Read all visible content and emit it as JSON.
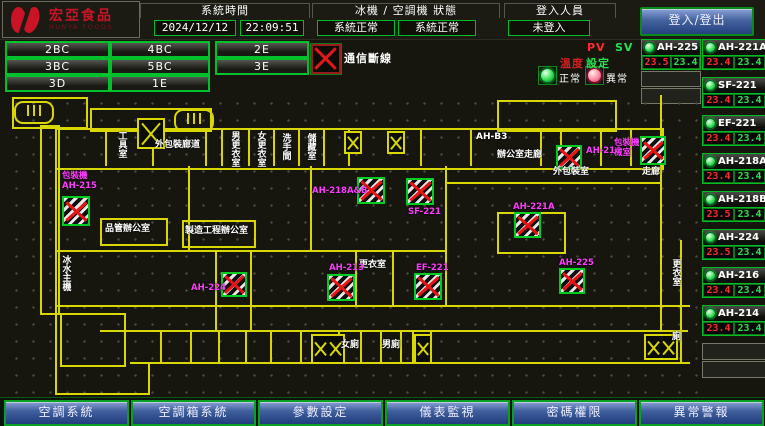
{
  "header": {
    "brand": {
      "name": "宏亞食品",
      "sub": "HUNYA FOODS"
    },
    "system_time": {
      "label": "系統時間",
      "date": "2024/12/12",
      "time": "22:09:51"
    },
    "machine_status": {
      "label": "冰機 / 空調機 狀態",
      "chiller": "系統正常",
      "ac": "系統正常"
    },
    "login": {
      "label": "登入人員",
      "status": "未登入",
      "button": "登入/登出"
    }
  },
  "floor_nav": {
    "buttons": [
      "2BC",
      "4BC",
      "2E",
      "3BC",
      "5BC",
      "3E",
      "3D",
      "1E"
    ]
  },
  "legend": {
    "comm_fail": "通信斷線",
    "normal": "正常",
    "abnormal": "異常"
  },
  "pv_sv": {
    "pv": "PV",
    "sv": "SV",
    "set_prefix": "溫度",
    "set_suffix": "設定"
  },
  "devices": {
    "left": [
      {
        "name": "AH-225",
        "pv": "23.5",
        "sv": "23.4"
      }
    ],
    "left_empty_slots": 2,
    "right": [
      {
        "name": "AH-221A",
        "pv": "23.4",
        "sv": "23.4"
      },
      {
        "name": "SF-221",
        "pv": "23.4",
        "sv": "23.4"
      },
      {
        "name": "EF-221",
        "pv": "23.4",
        "sv": "23.4"
      },
      {
        "name": "AH-218A",
        "pv": "23.4",
        "sv": "23.4"
      },
      {
        "name": "AH-218B",
        "pv": "23.5",
        "sv": "23.4"
      },
      {
        "name": "AH-224",
        "pv": "23.5",
        "sv": "23.4"
      },
      {
        "name": "AH-216",
        "pv": "23.4",
        "sv": "23.4"
      },
      {
        "name": "AH-214",
        "pv": "23.4",
        "sv": "23.4"
      }
    ],
    "right_empty_slots": 2
  },
  "bottom_nav": {
    "buttons": [
      "空調系統",
      "空調箱系統",
      "參數設定",
      "儀表監視",
      "密碼權限",
      "異常警報"
    ]
  },
  "floorplan": {
    "rooms": [
      {
        "label": "工具室",
        "x": 108,
        "y": 36,
        "vertical": true
      },
      {
        "label": "外包裝廊道",
        "x": 147,
        "y": 46,
        "vertical": false
      },
      {
        "label": "男更衣室",
        "x": 221,
        "y": 36,
        "vertical": true
      },
      {
        "label": "女更衣室",
        "x": 247,
        "y": 36,
        "vertical": true
      },
      {
        "label": "洗手間",
        "x": 272,
        "y": 38,
        "vertical": true
      },
      {
        "label": "儲藏室",
        "x": 297,
        "y": 38,
        "vertical": true
      },
      {
        "label": "AH-B3",
        "x": 468,
        "y": 38,
        "vertical": false
      },
      {
        "label": "辦公室走廊",
        "x": 489,
        "y": 56,
        "vertical": false
      },
      {
        "label": "品管辦公室",
        "x": 97,
        "y": 130,
        "vertical": false
      },
      {
        "label": "製造工程辦公室",
        "x": 177,
        "y": 132,
        "vertical": false
      },
      {
        "label": "冰水主機",
        "x": 52,
        "y": 160,
        "vertical": true
      },
      {
        "label": "更衣室",
        "x": 351,
        "y": 166,
        "vertical": false
      },
      {
        "label": "外包裝室",
        "x": 545,
        "y": 73,
        "vertical": false
      },
      {
        "label": "走廊",
        "x": 634,
        "y": 73,
        "vertical": false
      },
      {
        "label": "更衣室",
        "x": 662,
        "y": 164,
        "vertical": true
      },
      {
        "label": "女廁",
        "x": 333,
        "y": 246,
        "vertical": false
      },
      {
        "label": "男廁",
        "x": 374,
        "y": 246,
        "vertical": false
      },
      {
        "label": "廁",
        "x": 664,
        "y": 238,
        "vertical": false
      }
    ],
    "equipment_labels": [
      {
        "lines": [
          "包裝機",
          "AH-215"
        ],
        "x": 54,
        "y": 77
      },
      {
        "lines": [
          "AH-224"
        ],
        "x": 183,
        "y": 189
      },
      {
        "lines": [
          "AH-218A&B"
        ],
        "x": 304,
        "y": 92
      },
      {
        "lines": [
          "SF-221"
        ],
        "x": 400,
        "y": 113
      },
      {
        "lines": [
          "AH-221A"
        ],
        "x": 505,
        "y": 108
      },
      {
        "lines": [
          "AH-214"
        ],
        "x": 578,
        "y": 52
      },
      {
        "lines": [
          "包裝機",
          "械室"
        ],
        "x": 606,
        "y": 44
      },
      {
        "lines": [
          "AH-213"
        ],
        "x": 321,
        "y": 169
      },
      {
        "lines": [
          "EF-221"
        ],
        "x": 408,
        "y": 169
      },
      {
        "lines": [
          "AH-225"
        ],
        "x": 551,
        "y": 164
      }
    ],
    "alarm_boxes": [
      [
        54,
        101,
        28,
        30
      ],
      [
        213,
        177,
        26,
        25
      ],
      [
        349,
        82,
        28,
        27
      ],
      [
        398,
        83,
        28,
        27
      ],
      [
        506,
        117,
        27,
        26
      ],
      [
        548,
        50,
        26,
        24
      ],
      [
        632,
        41,
        26,
        29
      ],
      [
        319,
        179,
        28,
        27
      ],
      [
        406,
        178,
        28,
        27
      ],
      [
        551,
        173,
        26,
        26
      ]
    ],
    "elevator_boxes": [
      {
        "x": 129,
        "y": 23,
        "w": 24,
        "h": 27,
        "double": false
      },
      {
        "x": 336,
        "y": 36,
        "w": 14,
        "h": 19,
        "double": false
      },
      {
        "x": 379,
        "y": 36,
        "w": 14,
        "h": 19,
        "double": false
      },
      {
        "x": 303,
        "y": 239,
        "w": 30,
        "h": 26,
        "double": true
      },
      {
        "x": 406,
        "y": 239,
        "w": 14,
        "h": 26,
        "double": false
      },
      {
        "x": 636,
        "y": 239,
        "w": 30,
        "h": 22,
        "double": true
      }
    ],
    "stairs": [
      [
        6,
        6
      ],
      [
        166,
        14
      ]
    ],
    "walls": [
      [
        4,
        2,
        72,
        28
      ],
      [
        82,
        13,
        118,
        20
      ],
      [
        489,
        5,
        116,
        28
      ],
      [
        47,
        33,
        605,
        38
      ],
      [
        32,
        30,
        16,
        186
      ],
      [
        92,
        123,
        64,
        24
      ],
      [
        174,
        125,
        70,
        24
      ],
      [
        52,
        218,
        62,
        50
      ],
      [
        489,
        117,
        65,
        38
      ],
      [
        47,
        71,
        0,
        228
      ],
      [
        47,
        155,
        390,
        0
      ],
      [
        47,
        210,
        635,
        0
      ],
      [
        92,
        235,
        588,
        0
      ],
      [
        122,
        267,
        560,
        0
      ],
      [
        180,
        71,
        0,
        84
      ],
      [
        207,
        155,
        0,
        80
      ],
      [
        242,
        155,
        0,
        80
      ],
      [
        302,
        71,
        0,
        84
      ],
      [
        347,
        157,
        0,
        53
      ],
      [
        384,
        157,
        0,
        53
      ],
      [
        437,
        71,
        0,
        139
      ],
      [
        652,
        0,
        0,
        235
      ],
      [
        672,
        145,
        0,
        122
      ],
      [
        437,
        87,
        215,
        0
      ],
      [
        47,
        298,
        95,
        0
      ],
      [
        140,
        267,
        0,
        31
      ],
      [
        97,
        33,
        0,
        38
      ],
      [
        144,
        33,
        0,
        38
      ],
      [
        197,
        33,
        0,
        38
      ],
      [
        213,
        33,
        0,
        38
      ],
      [
        240,
        33,
        0,
        38
      ],
      [
        265,
        33,
        0,
        38
      ],
      [
        290,
        33,
        0,
        38
      ],
      [
        315,
        33,
        0,
        38
      ],
      [
        340,
        33,
        0,
        38
      ],
      [
        412,
        33,
        0,
        38
      ],
      [
        462,
        33,
        0,
        38
      ],
      [
        532,
        33,
        0,
        38
      ],
      [
        552,
        33,
        0,
        38
      ],
      [
        592,
        33,
        0,
        38
      ],
      [
        622,
        33,
        0,
        38
      ],
      [
        152,
        235,
        0,
        32
      ],
      [
        182,
        235,
        0,
        32
      ],
      [
        210,
        235,
        0,
        32
      ],
      [
        237,
        235,
        0,
        32
      ],
      [
        262,
        235,
        0,
        32
      ],
      [
        292,
        235,
        0,
        32
      ],
      [
        330,
        235,
        0,
        32
      ],
      [
        352,
        235,
        0,
        32
      ],
      [
        372,
        235,
        0,
        32
      ],
      [
        392,
        235,
        0,
        32
      ],
      [
        404,
        235,
        0,
        32
      ],
      [
        422,
        235,
        0,
        32
      ]
    ]
  },
  "colors": {
    "wall_yellow": "#d8d800",
    "alarm_red": "#e81414",
    "equip_magenta": "#ff3bff",
    "led_green": "#35e055",
    "led_pink": "#ff8aa2",
    "pv_red": "#ff2a2a",
    "sv_green": "#2ae04e",
    "button_blue": "#41609e",
    "border_green": "#00bb22",
    "brand_red": "#c81426"
  }
}
